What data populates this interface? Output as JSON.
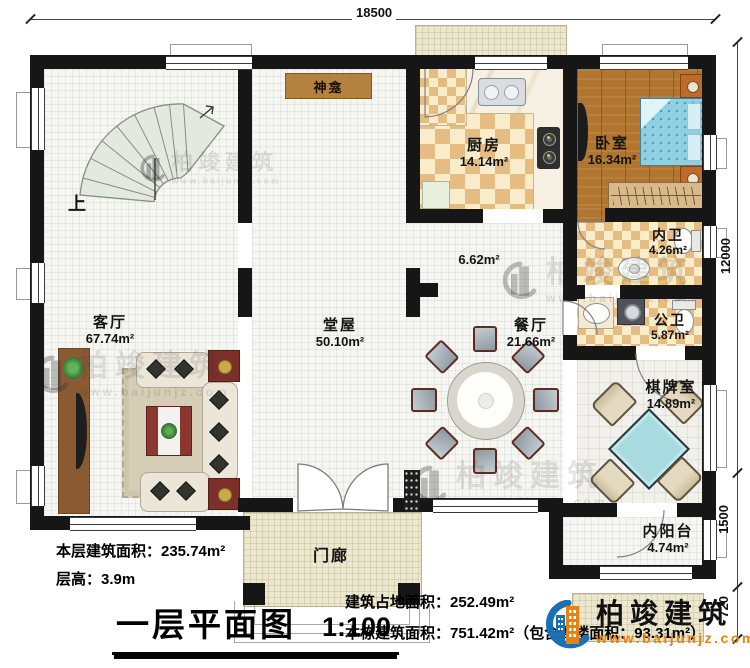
{
  "plan": {
    "dim_top": "18500",
    "dim_right_main": "12000",
    "dim_right_porch": "1500",
    "dim_right_steps": "720",
    "stairs_label": "上",
    "rooms": {
      "shrine": {
        "name": "神龛"
      },
      "kitchen": {
        "name": "厨房",
        "area": "14.14m²"
      },
      "bedroom": {
        "name": "卧室",
        "area": "16.34m²"
      },
      "inner_bath": {
        "name": "内卫",
        "area": "4.26m²"
      },
      "public_bath": {
        "name": "公卫",
        "area": "5.87m²"
      },
      "corridor": {
        "area": "6.62m²"
      },
      "dining": {
        "name": "餐厅",
        "area": "21.66m²"
      },
      "chess_room": {
        "name": "棋牌室",
        "area": "14.89m²"
      },
      "inner_balcony": {
        "name": "内阳台",
        "area": "4.74m²"
      },
      "hall": {
        "name": "堂屋",
        "area": "50.10m²"
      },
      "living": {
        "name": "客厅",
        "area": "67.74m²"
      },
      "porch": {
        "name": "门廊"
      }
    }
  },
  "footer": {
    "floor_area": "本层建筑面积：235.74m²",
    "floor_height": "层高：3.9m",
    "title": "一层平面图",
    "scale": "1:100",
    "site_area": "建筑占地面积：252.49m²",
    "building_area": "本栋建筑面积：751.42m²（包含阁楼面积：93.31m²）"
  },
  "brand": {
    "name": "柏竣建筑",
    "url": "www.baijunjz.com"
  },
  "watermark": {
    "name": "柏竣建筑",
    "url": "www.baijunjz.com"
  },
  "colors": {
    "accent_blue": "#1a6fb5",
    "accent_orange": "#e8820c",
    "wall": "#161616"
  }
}
